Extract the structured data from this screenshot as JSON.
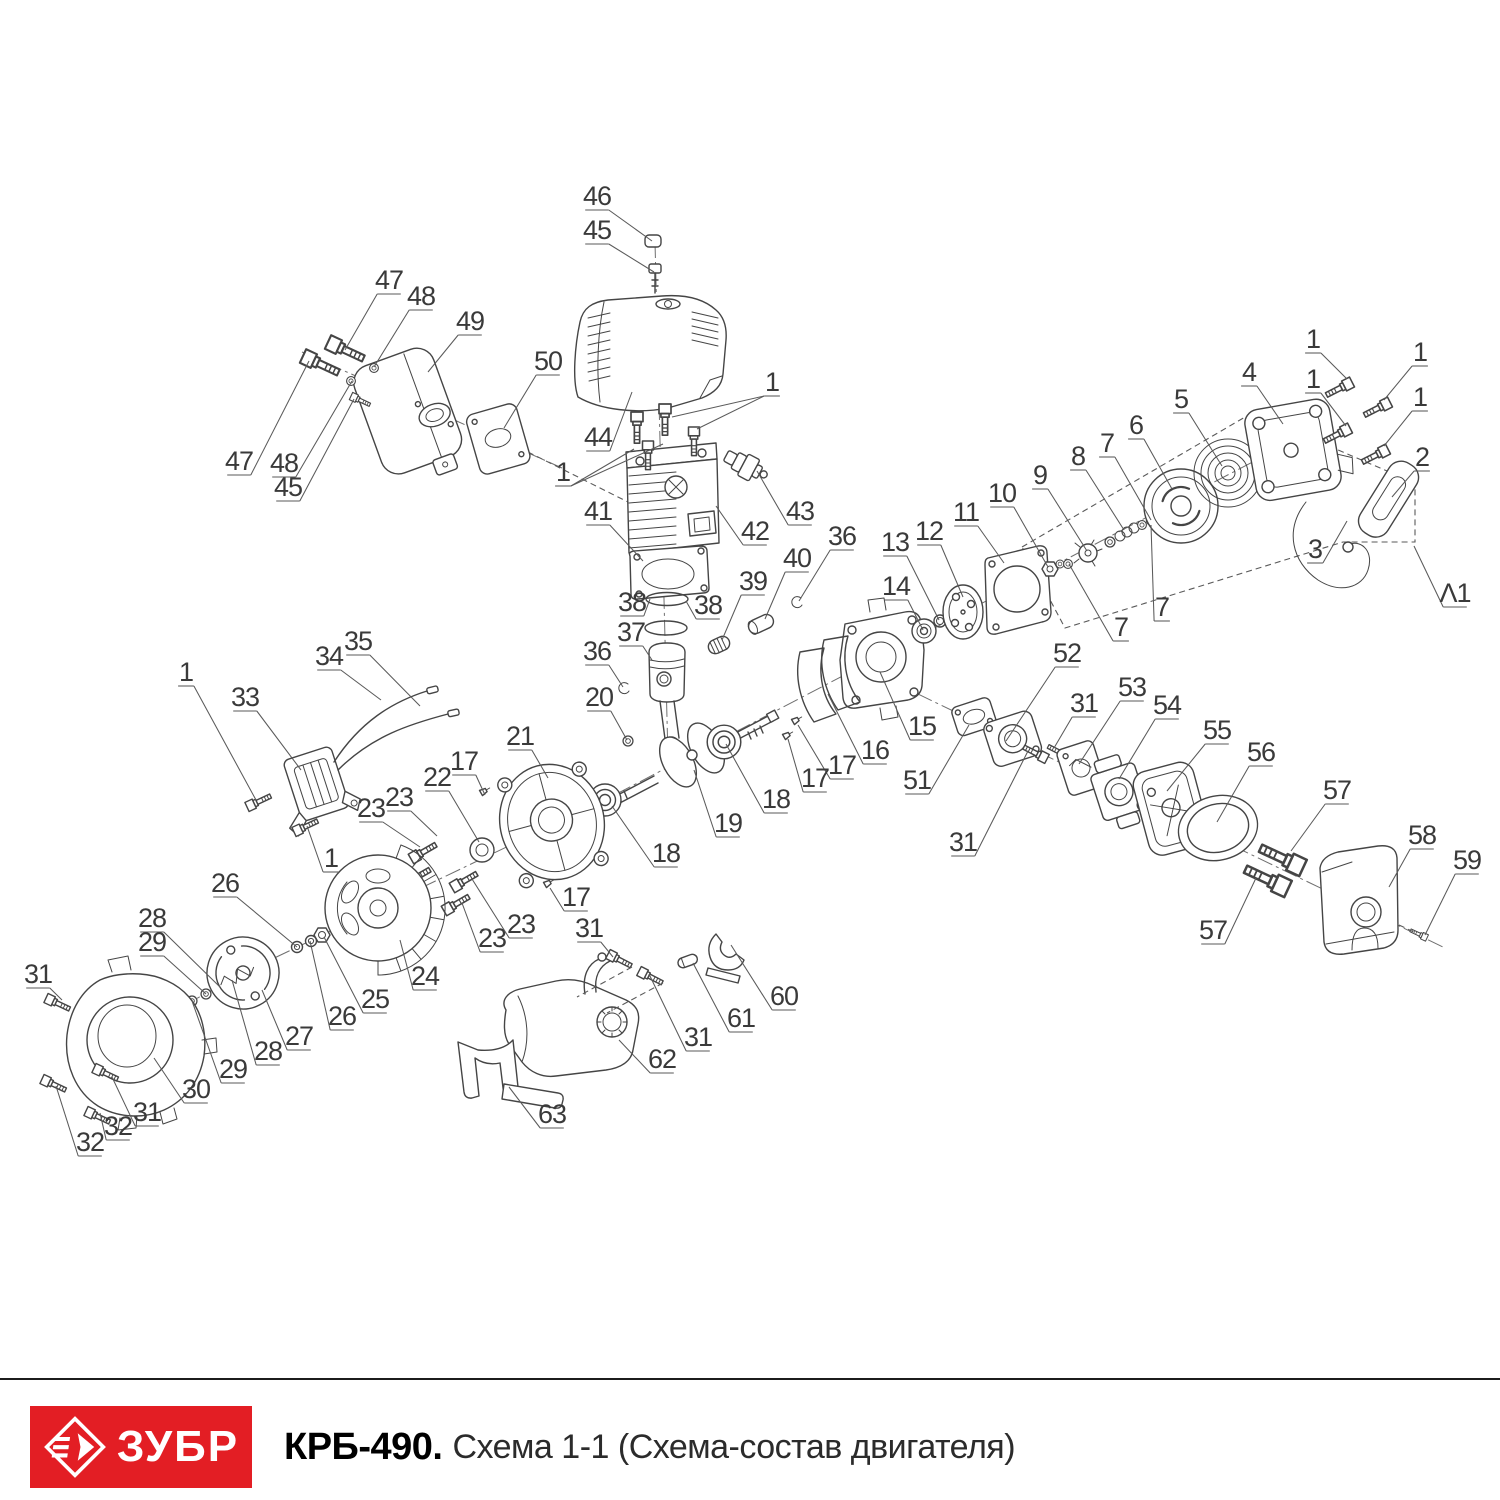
{
  "footer": {
    "logo_text": "ЗУБР",
    "model": "КРБ-490.",
    "subtitle": "Схема 1-1 (Схема-состав двигателя)"
  },
  "colors": {
    "brand_red": "#e31e24",
    "diagram_line": "#454545",
    "label_text": "#3a3a3a",
    "leader_line": "#5a5a5a",
    "background": "#ffffff"
  },
  "diagram": {
    "description": "Exploded view of engine assembly with numbered part callouts",
    "callouts": [
      {
        "t": "46",
        "x": 597,
        "y": 197,
        "p": [
          [
            652,
            241
          ]
        ]
      },
      {
        "t": "45",
        "x": 597,
        "y": 231,
        "p": [
          [
            654,
            272
          ]
        ]
      },
      {
        "t": "47",
        "x": 389,
        "y": 281,
        "p": [
          [
            345,
            350
          ]
        ]
      },
      {
        "t": "48",
        "x": 421,
        "y": 297,
        "p": [
          [
            374,
            367
          ]
        ]
      },
      {
        "t": "49",
        "x": 470,
        "y": 322,
        "p": [
          [
            428,
            372
          ]
        ]
      },
      {
        "t": "50",
        "x": 548,
        "y": 362,
        "p": [
          [
            504,
            428
          ]
        ]
      },
      {
        "t": "44",
        "x": 598,
        "y": 438,
        "p": [
          [
            632,
            392
          ]
        ]
      },
      {
        "t": "1",
        "x": 772,
        "y": 383,
        "p": [
          [
            672,
            417
          ],
          [
            697,
            429
          ]
        ]
      },
      {
        "t": "1",
        "x": 563,
        "y": 473,
        "p": [
          [
            634,
            449
          ],
          [
            663,
            444
          ]
        ]
      },
      {
        "t": "47",
        "x": 239,
        "y": 462,
        "p": [
          [
            309,
            361
          ]
        ]
      },
      {
        "t": "48",
        "x": 284,
        "y": 464,
        "p": [
          [
            352,
            381
          ]
        ]
      },
      {
        "t": "45",
        "x": 288,
        "y": 488,
        "p": [
          [
            354,
            399
          ]
        ]
      },
      {
        "t": "41",
        "x": 598,
        "y": 512,
        "p": [
          [
            643,
            561
          ]
        ]
      },
      {
        "t": "42",
        "x": 755,
        "y": 532,
        "p": [
          [
            716,
            506
          ]
        ]
      },
      {
        "t": "43",
        "x": 800,
        "y": 512,
        "p": [
          [
            757,
            471
          ]
        ]
      },
      {
        "t": "38",
        "x": 632,
        "y": 603,
        "p": [
          [
            650,
            599
          ]
        ]
      },
      {
        "t": "38",
        "x": 708,
        "y": 606,
        "p": [
          [
            686,
            601
          ]
        ]
      },
      {
        "t": "37",
        "x": 631,
        "y": 633,
        "p": [
          [
            652,
            660
          ]
        ]
      },
      {
        "t": "39",
        "x": 753,
        "y": 582,
        "p": [
          [
            722,
            640
          ]
        ]
      },
      {
        "t": "40",
        "x": 797,
        "y": 559,
        "p": [
          [
            765,
            619
          ]
        ]
      },
      {
        "t": "36",
        "x": 842,
        "y": 537,
        "p": [
          [
            799,
            601
          ]
        ]
      },
      {
        "t": "36",
        "x": 597,
        "y": 652,
        "p": [
          [
            623,
            687
          ]
        ]
      },
      {
        "t": "20",
        "x": 599,
        "y": 698,
        "p": [
          [
            627,
            740
          ]
        ]
      },
      {
        "t": "33",
        "x": 245,
        "y": 698,
        "p": [
          [
            301,
            770
          ]
        ]
      },
      {
        "t": "34",
        "x": 329,
        "y": 657,
        "p": [
          [
            381,
            700
          ]
        ]
      },
      {
        "t": "35",
        "x": 358,
        "y": 642,
        "p": [
          [
            420,
            706
          ]
        ]
      },
      {
        "t": "1",
        "x": 186,
        "y": 673,
        "p": [
          [
            256,
            800
          ]
        ]
      },
      {
        "t": "1",
        "x": 331,
        "y": 859,
        "p": [
          [
            307,
            826
          ]
        ]
      },
      {
        "t": "21",
        "x": 520,
        "y": 737,
        "p": [
          [
            548,
            778
          ]
        ]
      },
      {
        "t": "22",
        "x": 437,
        "y": 778,
        "p": [
          [
            479,
            842
          ]
        ]
      },
      {
        "t": "17",
        "x": 464,
        "y": 762,
        "p": [
          [
            485,
            795
          ]
        ]
      },
      {
        "t": "17",
        "x": 576,
        "y": 898,
        "p": [
          [
            550,
            888
          ]
        ]
      },
      {
        "t": "18",
        "x": 666,
        "y": 854,
        "p": [
          [
            612,
            806
          ]
        ]
      },
      {
        "t": "18",
        "x": 776,
        "y": 800,
        "p": [
          [
            726,
            744
          ]
        ]
      },
      {
        "t": "19",
        "x": 728,
        "y": 824,
        "p": [
          [
            694,
            770
          ]
        ]
      },
      {
        "t": "23",
        "x": 371,
        "y": 809,
        "p": [
          [
            420,
            847
          ]
        ]
      },
      {
        "t": "23",
        "x": 399,
        "y": 798,
        "p": [
          [
            437,
            836
          ]
        ]
      },
      {
        "t": "23",
        "x": 492,
        "y": 939,
        "p": [
          [
            462,
            903
          ]
        ]
      },
      {
        "t": "23",
        "x": 521,
        "y": 925,
        "p": [
          [
            472,
            879
          ]
        ]
      },
      {
        "t": "24",
        "x": 425,
        "y": 977,
        "p": [
          [
            400,
            940
          ]
        ]
      },
      {
        "t": "25",
        "x": 375,
        "y": 1000,
        "p": [
          [
            324,
            937
          ]
        ]
      },
      {
        "t": "26",
        "x": 225,
        "y": 884,
        "p": [
          [
            297,
            947
          ]
        ]
      },
      {
        "t": "26",
        "x": 342,
        "y": 1017,
        "p": [
          [
            310,
            941
          ]
        ]
      },
      {
        "t": "27",
        "x": 299,
        "y": 1037,
        "p": [
          [
            262,
            990
          ]
        ]
      },
      {
        "t": "28",
        "x": 152,
        "y": 919,
        "p": [
          [
            220,
            987
          ]
        ]
      },
      {
        "t": "29",
        "x": 152,
        "y": 943,
        "p": [
          [
            206,
            994
          ]
        ]
      },
      {
        "t": "28",
        "x": 268,
        "y": 1052,
        "p": [
          [
            232,
            980
          ]
        ]
      },
      {
        "t": "29",
        "x": 233,
        "y": 1070,
        "p": [
          [
            192,
            1001
          ]
        ]
      },
      {
        "t": "30",
        "x": 196,
        "y": 1090,
        "p": [
          [
            154,
            1058
          ]
        ]
      },
      {
        "t": "31",
        "x": 38,
        "y": 975,
        "p": [
          [
            62,
            1000
          ]
        ]
      },
      {
        "t": "31",
        "x": 147,
        "y": 1113,
        "p": [
          [
            112,
            1077
          ]
        ]
      },
      {
        "t": "32",
        "x": 118,
        "y": 1127,
        "p": [
          [
            100,
            1113
          ]
        ]
      },
      {
        "t": "32",
        "x": 90,
        "y": 1143,
        "p": [
          [
            56,
            1086
          ]
        ]
      },
      {
        "t": "11",
        "x": 966,
        "y": 513,
        "p": [
          [
            1004,
            563
          ]
        ]
      },
      {
        "t": "12",
        "x": 929,
        "y": 532,
        "p": [
          [
            963,
            597
          ]
        ]
      },
      {
        "t": "13",
        "x": 895,
        "y": 543,
        "p": [
          [
            939,
            620
          ]
        ]
      },
      {
        "t": "14",
        "x": 896,
        "y": 587,
        "p": [
          [
            923,
            630
          ]
        ]
      },
      {
        "t": "10",
        "x": 1002,
        "y": 494,
        "p": [
          [
            1048,
            567
          ]
        ]
      },
      {
        "t": "9",
        "x": 1040,
        "y": 476,
        "p": [
          [
            1087,
            551
          ]
        ]
      },
      {
        "t": "8",
        "x": 1078,
        "y": 457,
        "p": [
          [
            1124,
            530
          ]
        ]
      },
      {
        "t": "7",
        "x": 1107,
        "y": 444,
        "p": [
          [
            1151,
            520
          ]
        ]
      },
      {
        "t": "7",
        "x": 1162,
        "y": 608,
        "p": [
          [
            1151,
            525
          ]
        ]
      },
      {
        "t": "7",
        "x": 1121,
        "y": 628,
        "p": [
          [
            1069,
            564
          ]
        ]
      },
      {
        "t": "6",
        "x": 1136,
        "y": 426,
        "p": [
          [
            1172,
            489
          ]
        ]
      },
      {
        "t": "5",
        "x": 1181,
        "y": 400,
        "p": [
          [
            1222,
            466
          ]
        ]
      },
      {
        "t": "4",
        "x": 1249,
        "y": 373,
        "p": [
          [
            1283,
            424
          ]
        ]
      },
      {
        "t": "1",
        "x": 1313,
        "y": 340,
        "p": [
          [
            1347,
            379
          ]
        ]
      },
      {
        "t": "1",
        "x": 1420,
        "y": 353,
        "p": [
          [
            1384,
            400
          ]
        ]
      },
      {
        "t": "1",
        "x": 1313,
        "y": 380,
        "p": [
          [
            1346,
            426
          ]
        ]
      },
      {
        "t": "1",
        "x": 1420,
        "y": 398,
        "p": [
          [
            1384,
            446
          ]
        ]
      },
      {
        "t": "2",
        "x": 1422,
        "y": 458,
        "p": [
          [
            1392,
            497
          ]
        ]
      },
      {
        "t": "3",
        "x": 1315,
        "y": 550,
        "p": [
          [
            1347,
            521
          ]
        ]
      },
      {
        "t": "Λ1",
        "x": 1455,
        "y": 594,
        "p": [
          [
            1414,
            546
          ]
        ]
      },
      {
        "t": "15",
        "x": 922,
        "y": 727,
        "p": [
          [
            880,
            672
          ]
        ]
      },
      {
        "t": "16",
        "x": 875,
        "y": 751,
        "p": [
          [
            828,
            694
          ]
        ]
      },
      {
        "t": "17",
        "x": 842,
        "y": 766,
        "p": [
          [
            798,
            725
          ]
        ]
      },
      {
        "t": "17",
        "x": 815,
        "y": 779,
        "p": [
          [
            788,
            739
          ]
        ]
      },
      {
        "t": "51",
        "x": 917,
        "y": 781,
        "p": [
          [
            969,
            725
          ]
        ]
      },
      {
        "t": "52",
        "x": 1067,
        "y": 654,
        "p": [
          [
            1006,
            741
          ]
        ]
      },
      {
        "t": "31",
        "x": 963,
        "y": 843,
        "p": [
          [
            1028,
            751
          ]
        ]
      },
      {
        "t": "31",
        "x": 1084,
        "y": 704,
        "p": [
          [
            1054,
            748
          ]
        ]
      },
      {
        "t": "53",
        "x": 1132,
        "y": 688,
        "p": [
          [
            1079,
            764
          ]
        ]
      },
      {
        "t": "54",
        "x": 1167,
        "y": 706,
        "p": [
          [
            1119,
            779
          ]
        ]
      },
      {
        "t": "55",
        "x": 1217,
        "y": 731,
        "p": [
          [
            1167,
            791
          ]
        ]
      },
      {
        "t": "56",
        "x": 1261,
        "y": 753,
        "p": [
          [
            1217,
            822
          ]
        ]
      },
      {
        "t": "57",
        "x": 1337,
        "y": 791,
        "p": [
          [
            1291,
            851
          ]
        ]
      },
      {
        "t": "57",
        "x": 1213,
        "y": 931,
        "p": [
          [
            1256,
            878
          ]
        ]
      },
      {
        "t": "58",
        "x": 1422,
        "y": 836,
        "p": [
          [
            1389,
            887
          ]
        ]
      },
      {
        "t": "59",
        "x": 1467,
        "y": 861,
        "p": [
          [
            1425,
            935
          ]
        ]
      },
      {
        "t": "31",
        "x": 589,
        "y": 929,
        "p": [
          [
            613,
            957
          ]
        ]
      },
      {
        "t": "31",
        "x": 698,
        "y": 1038,
        "p": [
          [
            649,
            974
          ]
        ]
      },
      {
        "t": "60",
        "x": 784,
        "y": 997,
        "p": [
          [
            731,
            945
          ]
        ]
      },
      {
        "t": "61",
        "x": 741,
        "y": 1019,
        "p": [
          [
            693,
            963
          ]
        ]
      },
      {
        "t": "62",
        "x": 662,
        "y": 1060,
        "p": [
          [
            619,
            1040
          ]
        ]
      },
      {
        "t": "63",
        "x": 552,
        "y": 1115,
        "p": [
          [
            509,
            1087
          ]
        ]
      }
    ]
  }
}
